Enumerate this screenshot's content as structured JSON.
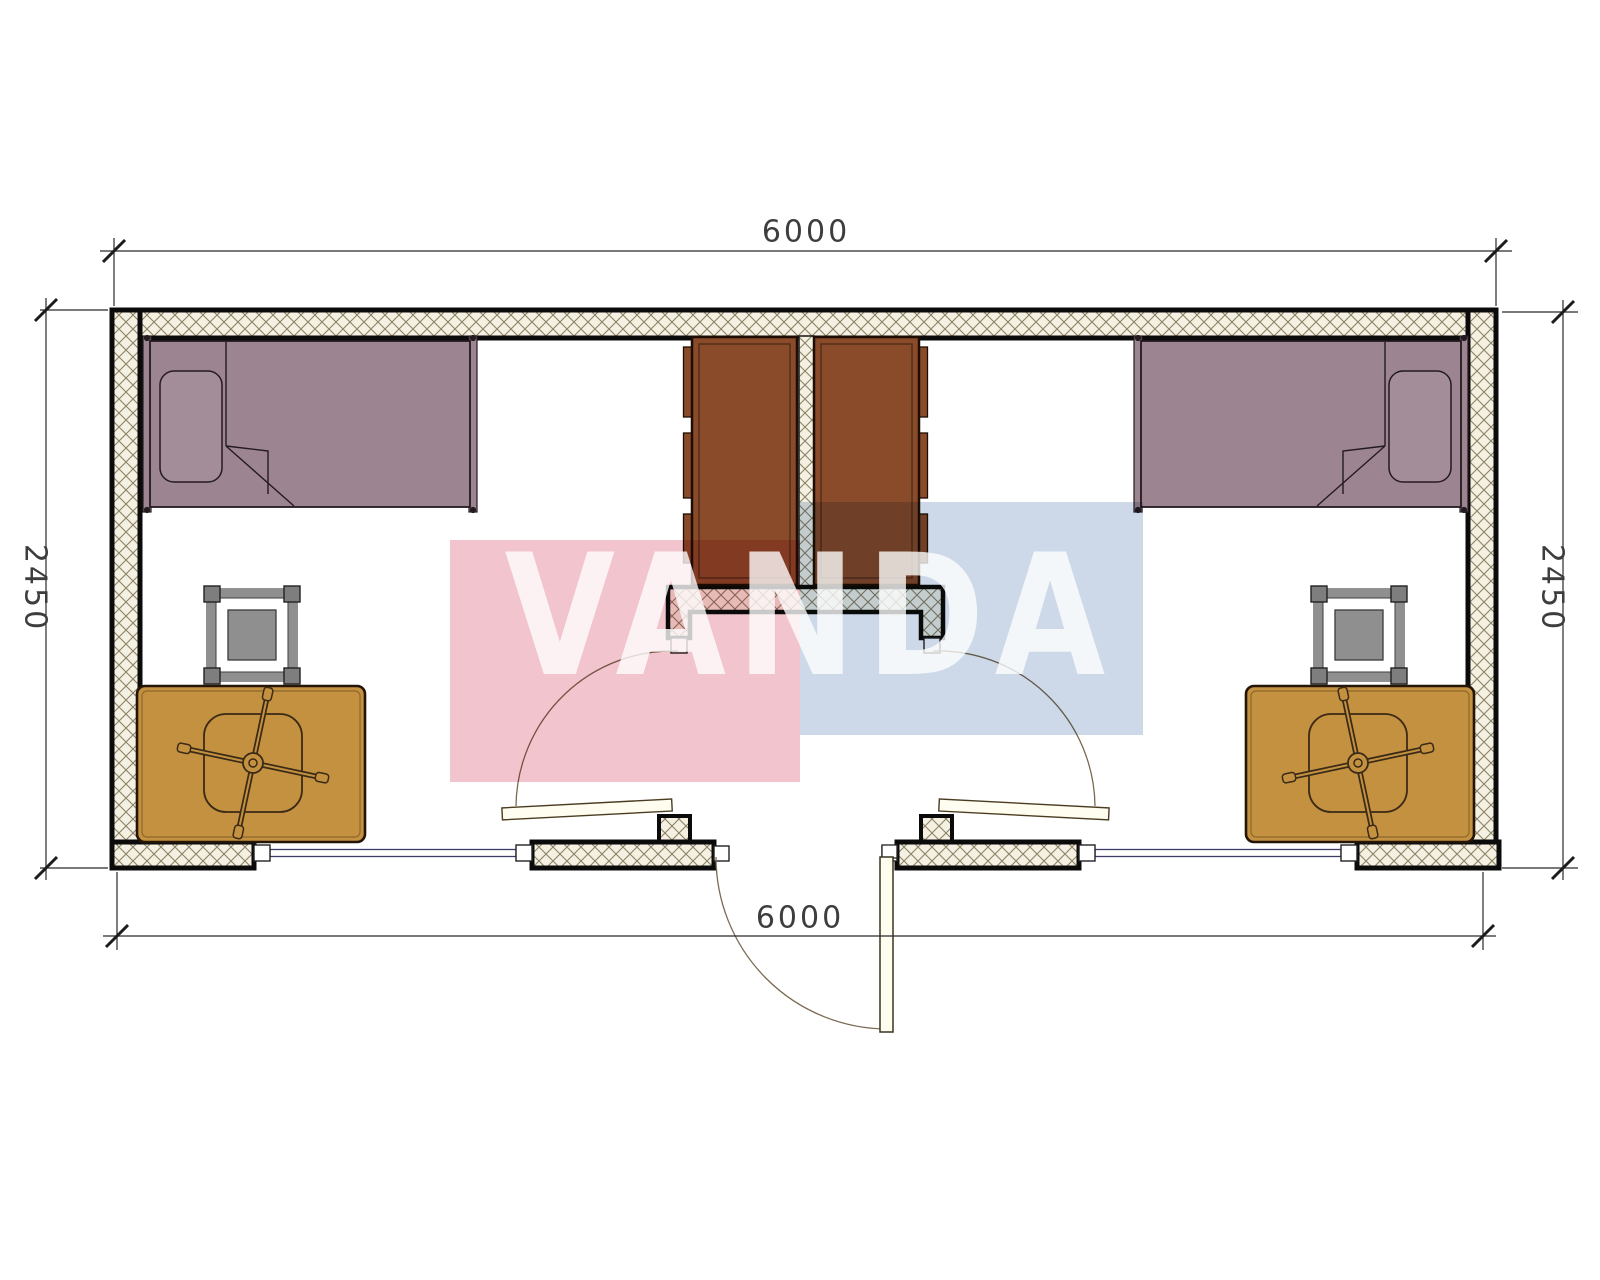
{
  "document": {
    "type": "architectural-floor-plan",
    "description": "Two-room container cabin plan with mirrored furniture layout"
  },
  "dimensions": {
    "top_width": "6000",
    "bottom_width": "6000",
    "left_height": "2450",
    "right_height": "2450"
  },
  "watermark": {
    "text": "VANDA",
    "pink": "#f2c5ce",
    "blue": "#cdd9e8"
  },
  "colors": {
    "bed": "#9c8591",
    "pillow": "#a28d99",
    "wardrobe": "#8a4b2a",
    "desk": "#c49140",
    "stool_gray": "#8f8f8f",
    "stool_corner": "#7e7e7e",
    "hatch_bg": "#f4f1e3",
    "hatch_line": "#8c8266",
    "wall_outline": "#0b0b0b",
    "glazing": "#3c3c68",
    "door_arc": "#7a6a50",
    "dim_text": "#3d3d3d"
  },
  "furniture": {
    "left_room": [
      "single-bed",
      "wardrobe",
      "desk",
      "office-chair",
      "side-table",
      "swing-door"
    ],
    "right_room": [
      "single-bed",
      "wardrobe",
      "desk",
      "office-chair",
      "side-table",
      "swing-door"
    ],
    "entry": [
      "exterior-swing-door",
      "window-left",
      "window-right"
    ]
  }
}
